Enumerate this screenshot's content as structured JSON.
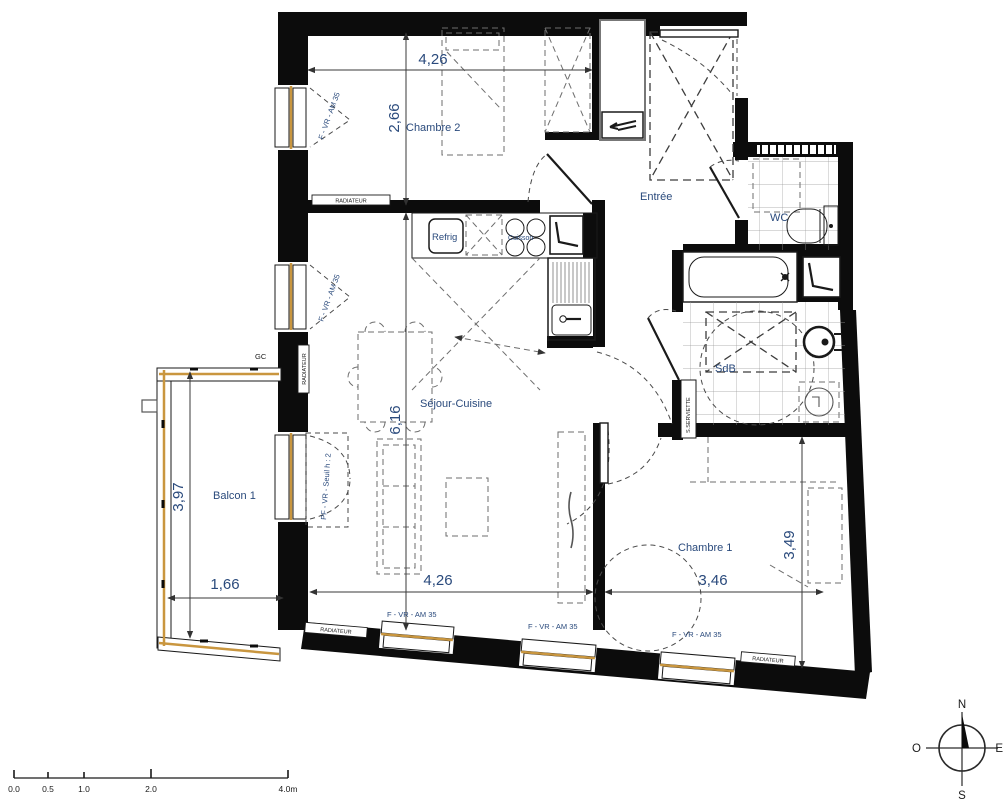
{
  "title": "Plan d'appartement 3 pièces",
  "rooms": {
    "chambre2": "Chambre 2",
    "entree": "Entrée",
    "wc": "WC",
    "sdb": "SdB",
    "sejour": "Séjour-Cuisine",
    "balcon": "Balcon 1",
    "chambre1": "Chambre 1"
  },
  "dimensions": {
    "chambre2_width": "4,26",
    "chambre2_height": "2,66",
    "sejour_height": "6,16",
    "balcon_height": "3,97",
    "balcon_width": "1,66",
    "sejour_width": "4,26",
    "chambre1_width": "3,46",
    "chambre1_height": "3,49"
  },
  "fixtures": {
    "refrigerator": "Refrig",
    "cooktop": "Cuisson",
    "radiator": "RADIATEUR",
    "towel_radiator": "S.SERVIETTE",
    "gc": "GC"
  },
  "windows": {
    "window_label": "F - VR - AM 35",
    "balcony_door_label": "PF - VR - Seuil h : 2"
  },
  "compass": {
    "north": "N",
    "south": "S",
    "east": "E",
    "west": "O"
  },
  "scale_bar": {
    "ticks": [
      "0.0",
      "0.5",
      "1.0",
      "2.0"
    ],
    "end": "4.0m"
  },
  "colors": {
    "wall": "#0c0c0c",
    "label_blue": "#2a4a7c",
    "window_sill_tan": "#c9963f",
    "tile_line": "#9a9a9a"
  }
}
